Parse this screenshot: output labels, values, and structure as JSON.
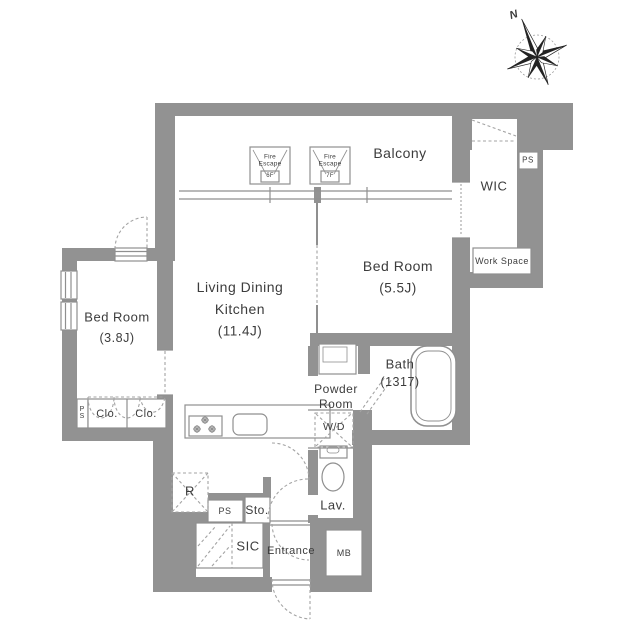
{
  "compass": {
    "north_label": "N"
  },
  "balcony": {
    "label": "Balcony",
    "fire_escapes": [
      {
        "line1": "Fire",
        "line2": "Escape",
        "floor": "6F"
      },
      {
        "line1": "Fire",
        "line2": "Escape",
        "floor": "7F"
      }
    ]
  },
  "rooms": {
    "ldk": {
      "line1": "Living Dining",
      "line2": "Kitchen",
      "size": "(11.4J)"
    },
    "bedroom_main": {
      "label": "Bed Room",
      "size": "(5.5J)"
    },
    "bedroom_second": {
      "label": "Bed Room",
      "size": "(3.8J)"
    },
    "bath": {
      "label": "Bath",
      "size": "(1317)"
    },
    "powder_room": {
      "line1": "Powder",
      "line2": "Room"
    },
    "wic": {
      "label": "WIC"
    },
    "work_space": {
      "label": "Work Space"
    },
    "lavatory": {
      "label": "Lav."
    },
    "washer_dryer": {
      "label": "W/D"
    },
    "closet_left": {
      "label": "Clo."
    },
    "closet_right": {
      "label": "Clo."
    },
    "entrance": {
      "label": "Entrance"
    },
    "shoe_closet": {
      "label": "SIC"
    },
    "storage": {
      "label": "Sto."
    },
    "refrigerator": {
      "label": "R"
    },
    "mail_box": {
      "label": "MB"
    },
    "pipe_space_left": {
      "label": "PS"
    },
    "pipe_space_bottom": {
      "label": "PS"
    },
    "pipe_space_top": {
      "label": "PS"
    }
  },
  "colors": {
    "wall": "#929292",
    "line": "#8f8f8f",
    "dash": "#a3a3a3",
    "text": "#3c3c3c",
    "background": "#ffffff"
  }
}
